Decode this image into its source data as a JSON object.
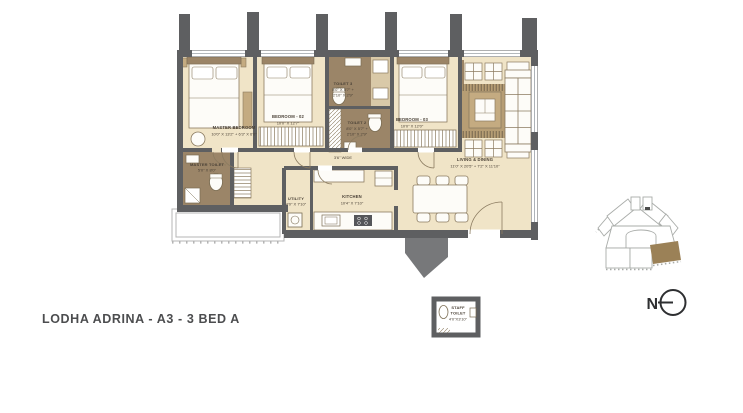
{
  "title": "LODHA ADRINA - A3 - 3 BED A",
  "compass": {
    "label": "N"
  },
  "colors": {
    "wall": "#5e5f61",
    "floor": "#f0e4c7",
    "toilet_floor": "#9b8568",
    "wood": "#c4ab81",
    "rug": "#b69d74",
    "keyplan_highlight": "#9b8157",
    "label_text": "#4a4136",
    "title_text": "#4c4d4f"
  },
  "rooms": {
    "master_bedroom": {
      "name": "MASTER BEDROOM",
      "dims": "10'0\" X 13'2\" + 6'3\" X 6'0\""
    },
    "bedroom_02": {
      "name": "BEDROOM - 02",
      "dims": "10'0\" X 12'7\""
    },
    "bedroom_03": {
      "name": "BEDROOM - 03",
      "dims": "10'0\" X 12'0\""
    },
    "toilet_3": {
      "name": "TOILET 3",
      "dims_1": "8'0\" X 5'7\" +",
      "dims_2": "2'10\" X 2'9\""
    },
    "toilet_2": {
      "name": "TOILET 2",
      "dims_1": "8'0\" X 5'7\" +",
      "dims_2": "2'10\" X 2'9\""
    },
    "master_toilet": {
      "name": "MASTER TOILET",
      "dims": "5'0\" X 8'0\""
    },
    "living_dining": {
      "name": "LIVING & DINING",
      "dims": "11'0\" X 20'5\" + 7'2\" X 11'10\""
    },
    "kitchen": {
      "name": "KITCHEN",
      "dims": "10'4\" X 7'10\""
    },
    "utility": {
      "name": "UTILITY",
      "dims": "4'0\" X 7'10\""
    },
    "passage": {
      "dims": "3'6\" WIDE"
    },
    "staff_toilet": {
      "name_1": "STAFF",
      "name_2": "TOILET",
      "dims": "4'0\"X3'10\""
    }
  }
}
